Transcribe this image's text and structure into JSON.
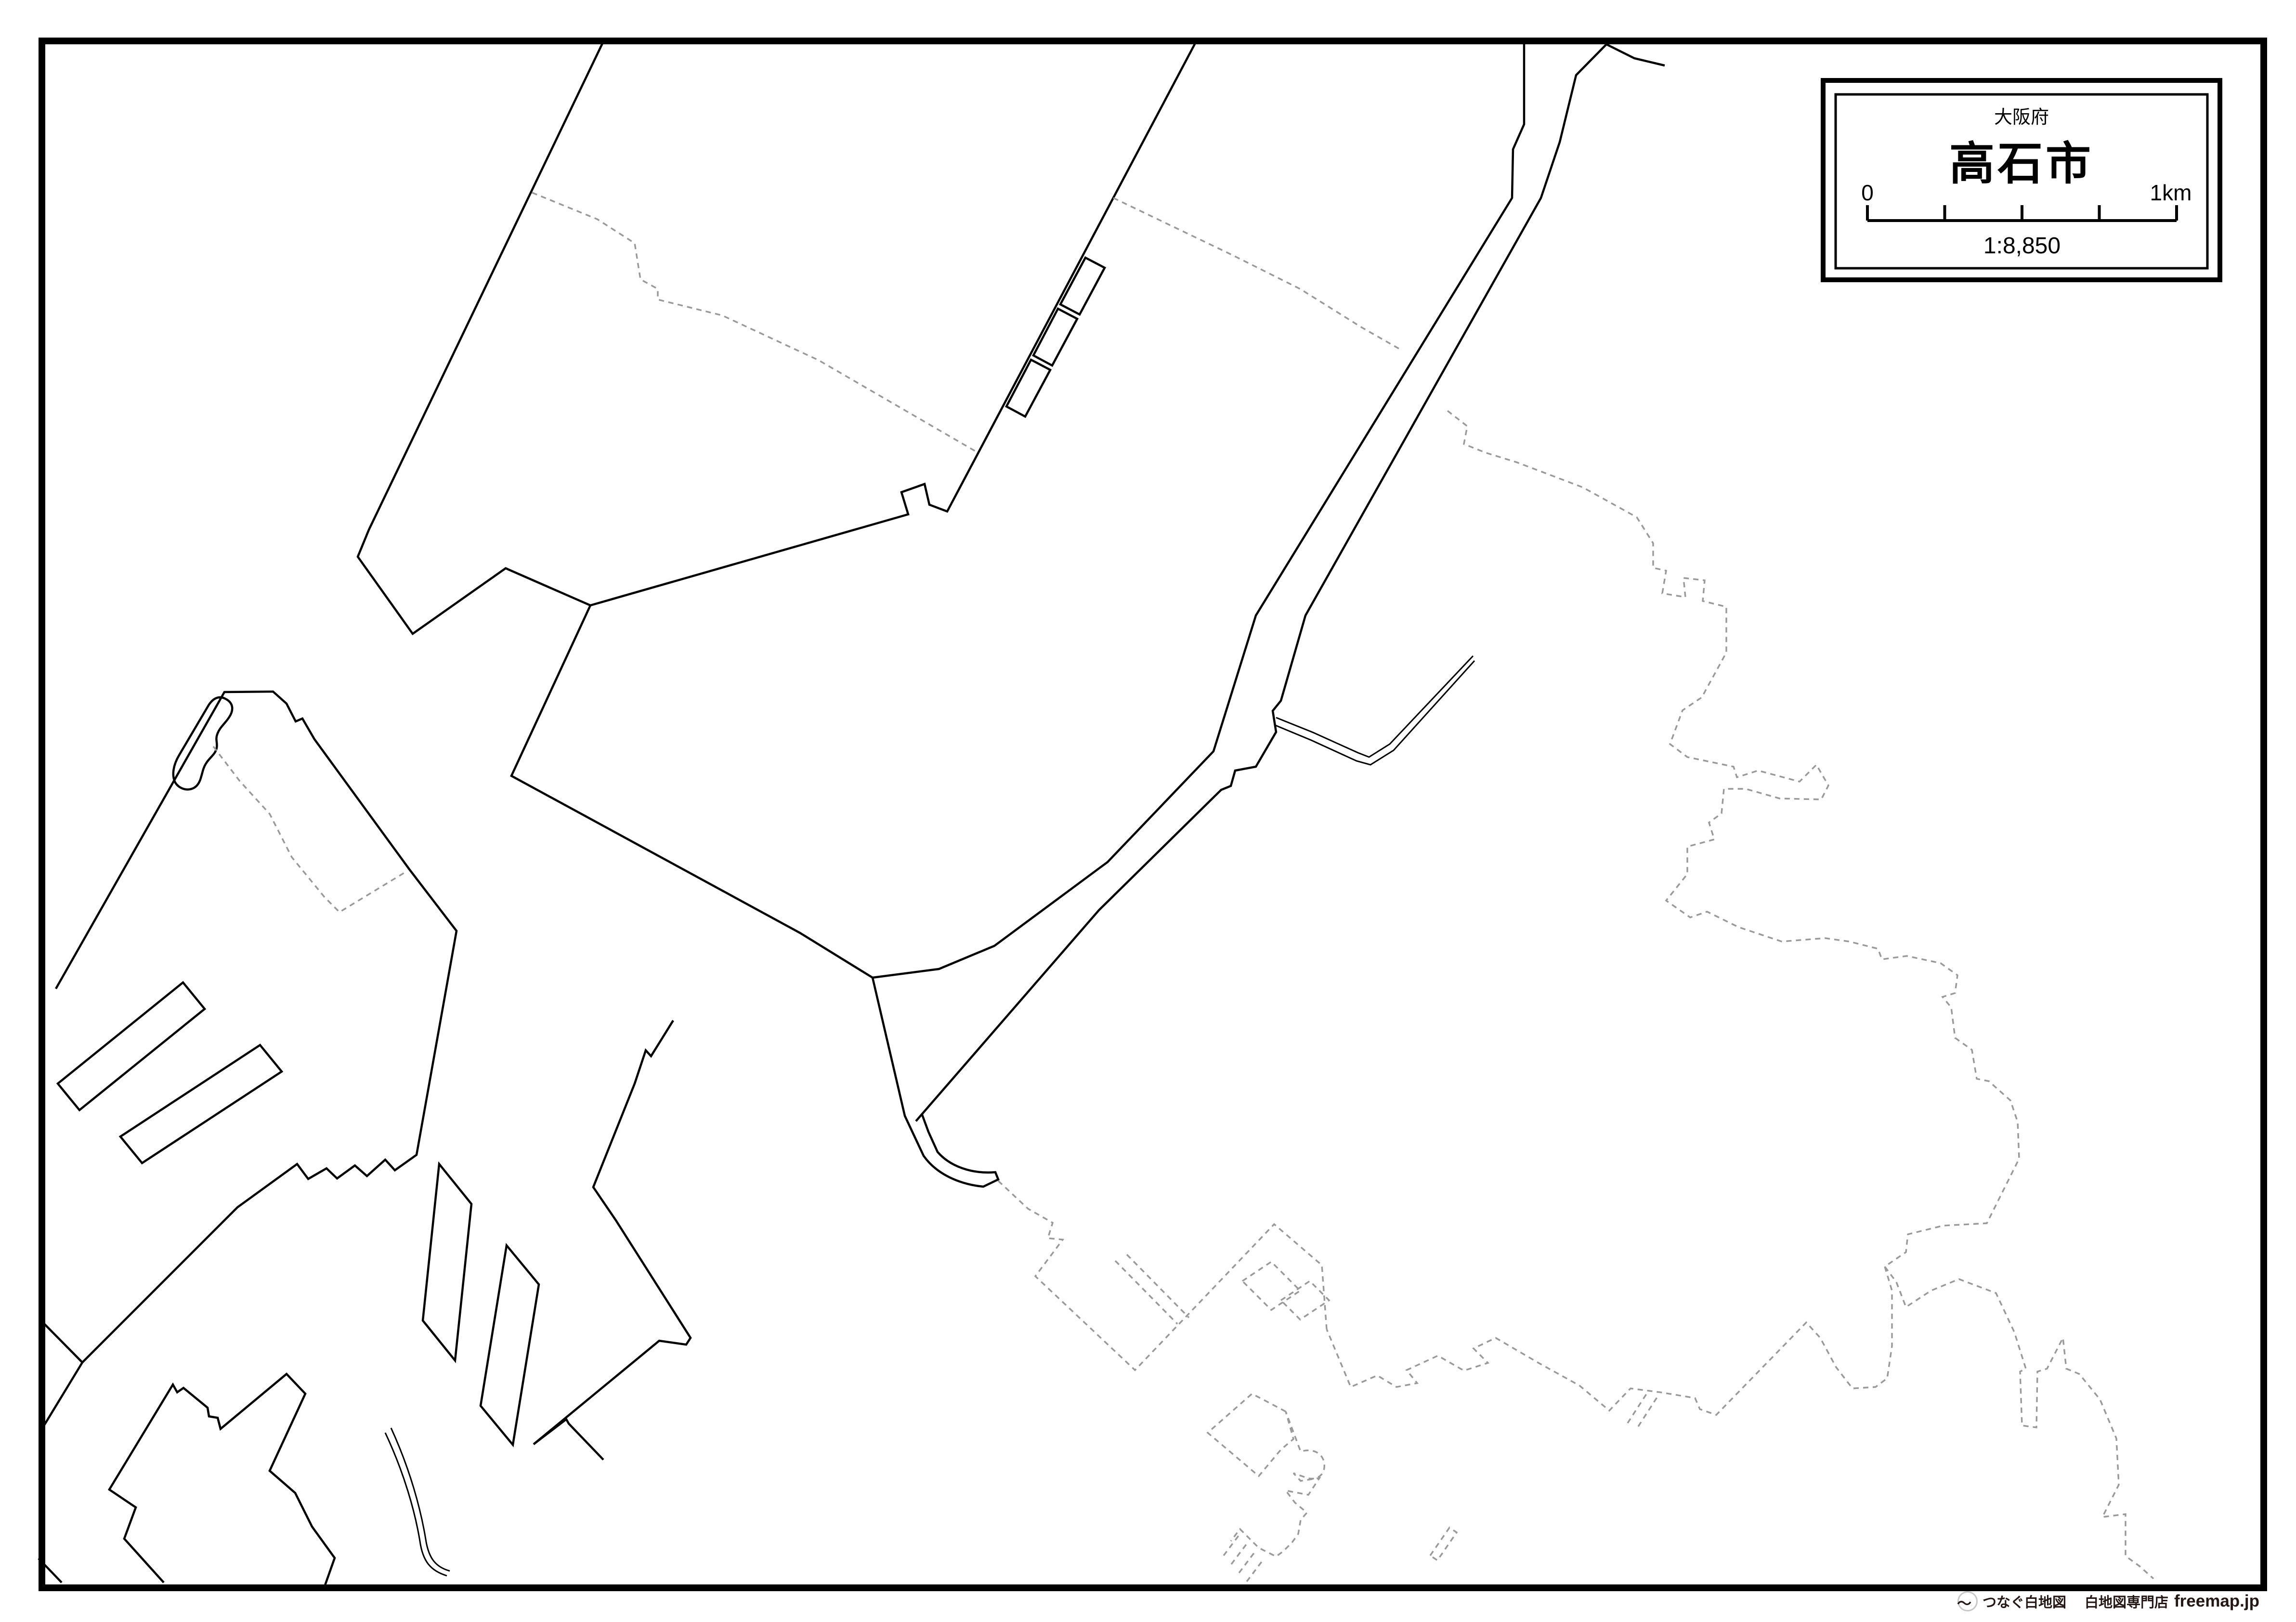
{
  "title_box": {
    "prefecture": "大阪府",
    "city": "高石市",
    "scale_zero": "0",
    "scale_max": "1km",
    "scale_ratio": "1:8,850"
  },
  "footer": {
    "logo_icon": "wave-circle-icon",
    "brand": "つなぐ白地図",
    "shop": "白地図専門店",
    "site": "freemap.jp"
  },
  "colors": {
    "background": "#ffffff",
    "frame": "#000000",
    "coastline": "#000000",
    "boundary_dotted": "#999999",
    "footer_text": "#231815",
    "logo_ring": "#c8c8c8"
  }
}
